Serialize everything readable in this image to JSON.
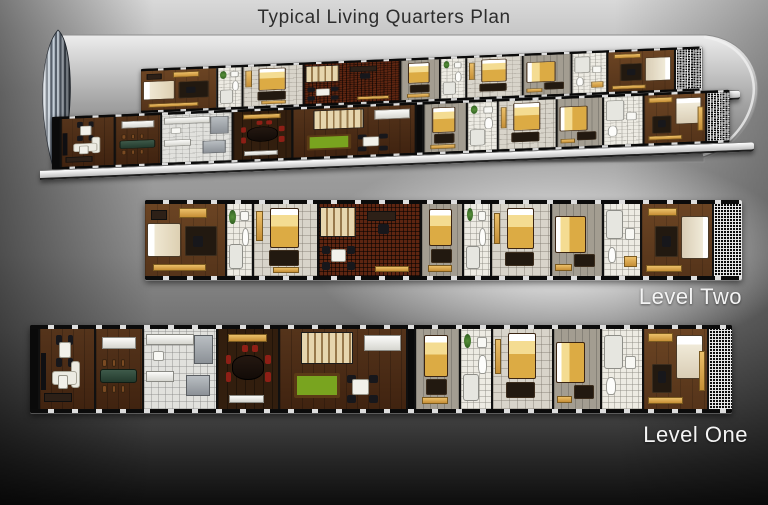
{
  "title": "Typical Living Quarters Plan",
  "view": {
    "perspective_caption": "cutaway perspective of both levels inside cylindrical hull",
    "hull_color": "#a8a8a8",
    "rib_cap_colors": [
      "#c2ccd6",
      "#4e5864"
    ]
  },
  "colors": {
    "background_top": "#d9d9d9",
    "background_bottom": "#0d0d0d",
    "title_text": "#2d2d2d",
    "label_text": "#f4f4f4",
    "wood_floor": "#6b4423",
    "dark_wood_floor": "#55341b",
    "corridor_carpet": "#5d2511",
    "gold_bed": "#dcab44",
    "cabinet_tan": "#ecc06a",
    "pool_table": "#79a41f"
  },
  "levels": [
    {
      "id": "two",
      "label": "Level Two",
      "strip": {
        "x": 145,
        "y": 200,
        "w": 597,
        "h": 80
      },
      "rooms": [
        {
          "n": "bedroom-1",
          "f": "wood",
          "x": 0,
          "w": 80,
          "items": [
            [
              "cab",
              42,
              6,
              36,
              13
            ],
            [
              "desk",
              8,
              8,
              20,
              14
            ],
            [
              "bedwl",
              3,
              26,
              42,
              48
            ],
            [
              "rug",
              50,
              30,
              40,
              42
            ],
            [
              "chd",
              60,
              44,
              12,
              16
            ],
            [
              "cab",
              10,
              84,
              66,
              9
            ]
          ]
        },
        {
          "n": "bathroom-1",
          "f": "bath",
          "x": 80,
          "w": 27,
          "items": [
            [
              "plant",
              8,
              8,
              26,
              20
            ],
            [
              "sink",
              52,
              10,
              34,
              14
            ],
            [
              "toil",
              58,
              34,
              30,
              24
            ],
            [
              "tub",
              8,
              56,
              54,
              34
            ]
          ]
        },
        {
          "n": "bedroom-2",
          "f": "tile",
          "x": 107,
          "w": 65,
          "items": [
            [
              "cab",
              3,
              10,
              11,
              42
            ],
            [
              "bedgt",
              26,
              5,
              46,
              56
            ],
            [
              "rug",
              24,
              64,
              48,
              22
            ],
            [
              "cab",
              30,
              88,
              42,
              8
            ]
          ]
        },
        {
          "n": "corridor-stairs",
          "f": "cork",
          "x": 172,
          "w": 103,
          "items": [
            [
              "stair",
              1,
              4,
              36,
              42
            ],
            [
              "desk",
              48,
              10,
              28,
              13
            ],
            [
              "chd",
              58,
              28,
              11,
              14
            ],
            [
              "chd",
              3,
              58,
              8,
              12
            ],
            [
              "tblw",
              12,
              62,
              15,
              18
            ],
            [
              "chd",
              28,
              58,
              8,
              12
            ],
            [
              "chd",
              3,
              80,
              8,
              12
            ],
            [
              "chd",
              28,
              80,
              8,
              12
            ],
            [
              "cab",
              55,
              86,
              34,
              9
            ]
          ]
        },
        {
          "n": "bedroom-3",
          "f": "gray",
          "x": 275,
          "w": 42,
          "items": [
            [
              "bedgt",
              18,
              7,
              58,
              52
            ],
            [
              "rug",
              22,
              62,
              52,
              20
            ],
            [
              "cab",
              14,
              85,
              62,
              9
            ]
          ]
        },
        {
          "n": "bathroom-2",
          "f": "bath",
          "x": 317,
          "w": 28,
          "items": [
            [
              "plant",
              10,
              6,
              24,
              18
            ],
            [
              "sink",
              52,
              10,
              34,
              14
            ],
            [
              "toil",
              56,
              34,
              30,
              24
            ],
            [
              "tub",
              8,
              58,
              52,
              32
            ]
          ]
        },
        {
          "n": "bedroom-4",
          "f": "tile",
          "x": 345,
          "w": 60,
          "items": [
            [
              "cab",
              3,
              12,
              11,
              44
            ],
            [
              "bedgt",
              25,
              5,
              48,
              58
            ],
            [
              "rug",
              22,
              66,
              50,
              20
            ]
          ]
        },
        {
          "n": "bedroom-5",
          "f": "gray",
          "x": 405,
          "w": 52,
          "items": [
            [
              "bedgl",
              5,
              16,
              62,
              52
            ],
            [
              "rug",
              44,
              70,
              42,
              18
            ],
            [
              "cab",
              6,
              84,
              34,
              9
            ]
          ]
        },
        {
          "n": "bathroom-3",
          "f": "bath",
          "x": 457,
          "w": 38,
          "items": [
            [
              "tub",
              6,
              8,
              46,
              40
            ],
            [
              "toil",
              10,
              60,
              24,
              22
            ],
            [
              "sink",
              58,
              34,
              28,
              16
            ],
            [
              "cab",
              56,
              72,
              36,
              16
            ]
          ]
        },
        {
          "n": "master-bedroom",
          "f": "wood",
          "x": 495,
          "w": 72,
          "items": [
            [
              "cab",
              8,
              5,
              42,
              12
            ],
            [
              "rug",
              18,
              30,
              34,
              44
            ],
            [
              "chd",
              28,
              44,
              13,
              16
            ],
            [
              "bedwr",
              56,
              16,
              40,
              60
            ],
            [
              "cab",
              5,
              85,
              52,
              9
            ]
          ]
        },
        {
          "n": "end-cap",
          "f": "hatch",
          "x": 567,
          "w": 30,
          "items": []
        }
      ]
    },
    {
      "id": "one",
      "label": "Level One",
      "strip": {
        "x": 30,
        "y": 325,
        "w": 702,
        "h": 88
      },
      "rooms": [
        {
          "n": "edge-wall",
          "f": "black",
          "x": 0,
          "w": 8,
          "items": []
        },
        {
          "n": "lounge",
          "f": "woodd",
          "x": 8,
          "w": 56,
          "items": [
            [
              "tv",
              2,
              30,
              9,
              46
            ],
            [
              "chd",
              30,
              8,
              10,
              12
            ],
            [
              "chd",
              52,
              8,
              10,
              12
            ],
            [
              "tblw",
              36,
              16,
              22,
              20
            ],
            [
              "chd",
              30,
              36,
              10,
              12
            ],
            [
              "chd",
              52,
              36,
              10,
              12
            ],
            [
              "sofw",
              58,
              40,
              16,
              34
            ],
            [
              "sofw",
              22,
              52,
              46,
              18
            ],
            [
              "tblw",
              34,
              58,
              18,
              17
            ],
            [
              "desk",
              8,
              80,
              52,
              11
            ]
          ]
        },
        {
          "n": "dining-bar",
          "f": "woodd",
          "x": 64,
          "w": 48,
          "items": [
            [
              "cntr",
              12,
              10,
              74,
              15
            ],
            [
              "chbr",
              14,
              38,
              9,
              10
            ],
            [
              "chbr",
              34,
              38,
              9,
              10
            ],
            [
              "chbr",
              54,
              38,
              9,
              10
            ],
            [
              "dtbl",
              8,
              50,
              82,
              17
            ],
            [
              "chbr",
              14,
              70,
              9,
              10
            ],
            [
              "chbr",
              34,
              70,
              9,
              10
            ],
            [
              "chbr",
              54,
              70,
              9,
              10
            ]
          ]
        },
        {
          "n": "kitchen",
          "f": "kit",
          "x": 112,
          "w": 74,
          "items": [
            [
              "cntr",
              3,
              6,
              66,
              14
            ],
            [
              "appl",
              70,
              8,
              26,
              36
            ],
            [
              "sink",
              12,
              28,
              16,
              12
            ],
            [
              "cntr",
              3,
              52,
              38,
              14
            ],
            [
              "appl",
              58,
              58,
              34,
              26
            ]
          ]
        },
        {
          "n": "formal-dining",
          "f": "dark",
          "x": 186,
          "w": 62,
          "items": [
            [
              "cab",
              16,
              6,
              66,
              10
            ],
            [
              "chr",
              40,
              20,
              10,
              9
            ],
            [
              "chr",
              56,
              20,
              10,
              9
            ],
            [
              "dtblo",
              24,
              32,
              52,
              32
            ],
            [
              "chr",
              13,
              32,
              9,
              12
            ],
            [
              "chr",
              13,
              54,
              9,
              12
            ],
            [
              "chr",
              79,
              32,
              9,
              12
            ],
            [
              "chr",
              79,
              54,
              9,
              12
            ],
            [
              "cntr",
              18,
              82,
              58,
              10
            ]
          ]
        },
        {
          "n": "recreation",
          "f": "woodd",
          "x": 248,
          "w": 128,
          "items": [
            [
              "stair",
              17,
              4,
              41,
              40
            ],
            [
              "cntr",
              67,
              8,
              29,
              20
            ],
            [
              "pool",
              11,
              55,
              37,
              31
            ],
            [
              "chd",
              53,
              58,
              7,
              10
            ],
            [
              "tblw",
              57,
              62,
              14,
              20
            ],
            [
              "chd",
              71,
              58,
              7,
              10
            ],
            [
              "chd",
              53,
              82,
              7,
              10
            ],
            [
              "chd",
              71,
              82,
              7,
              10
            ]
          ]
        },
        {
          "n": "mid-wall",
          "f": "black",
          "x": 376,
          "w": 8,
          "items": []
        },
        {
          "n": "bedroom-1",
          "f": "gray",
          "x": 384,
          "w": 45,
          "items": [
            [
              "bedgt",
              19,
              8,
              56,
              52
            ],
            [
              "rug",
              23,
              62,
              50,
              20
            ],
            [
              "cab",
              14,
              85,
              60,
              9
            ]
          ]
        },
        {
          "n": "bathroom-1",
          "f": "bath",
          "x": 429,
          "w": 32,
          "items": [
            [
              "plant",
              10,
              6,
              24,
              18
            ],
            [
              "sink",
              54,
              10,
              32,
              14
            ],
            [
              "toil",
              58,
              32,
              28,
              24
            ],
            [
              "tub",
              8,
              56,
              52,
              34
            ]
          ]
        },
        {
          "n": "bedroom-2",
          "f": "tile",
          "x": 461,
          "w": 61,
          "items": [
            [
              "cab",
              3,
              12,
              11,
              44
            ],
            [
              "bedgt",
              25,
              5,
              48,
              58
            ],
            [
              "rug",
              22,
              66,
              50,
              20
            ]
          ]
        },
        {
          "n": "bedroom-3",
          "f": "gray",
          "x": 522,
          "w": 48,
          "items": [
            [
              "bedgl",
              5,
              16,
              62,
              52
            ],
            [
              "rug",
              44,
              70,
              42,
              18
            ],
            [
              "cab",
              6,
              84,
              34,
              9
            ]
          ]
        },
        {
          "n": "bathroom-2",
          "f": "bath",
          "x": 570,
          "w": 42,
          "items": [
            [
              "tub",
              6,
              8,
              46,
              42
            ],
            [
              "toil",
              10,
              60,
              24,
              22
            ],
            [
              "sink",
              58,
              34,
              28,
              16
            ]
          ]
        },
        {
          "n": "master-bedroom",
          "f": "wood",
          "x": 612,
          "w": 65,
          "items": [
            [
              "cab",
              6,
              5,
              40,
              11
            ],
            [
              "bedwt",
              50,
              8,
              44,
              54
            ],
            [
              "rug",
              12,
              44,
              32,
              36
            ],
            [
              "chd",
              22,
              52,
              13,
              16
            ],
            [
              "cab",
              88,
              28,
              9,
              50
            ],
            [
              "cab",
              6,
              85,
              56,
              9
            ]
          ]
        },
        {
          "n": "end-cap",
          "f": "hatch",
          "x": 677,
          "w": 25,
          "items": []
        }
      ]
    }
  ]
}
